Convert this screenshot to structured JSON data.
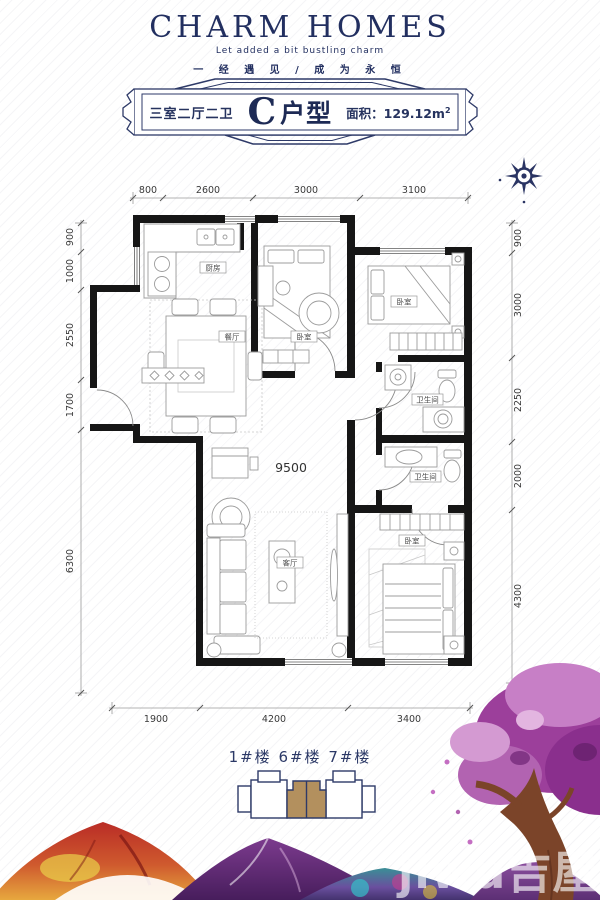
{
  "header": {
    "title": "CHARM HOMES",
    "subtitle": "Let added a bit bustling charm",
    "tagline": "一 经 遇 见 / 成 为 永 恒"
  },
  "banner": {
    "rooms": "三室二厅二卫",
    "unit_letter": "C",
    "unit_suffix": "户型",
    "area_label": "面积：129.12m",
    "area_sup": "2"
  },
  "plan": {
    "labels": {
      "kitchen": "厨房",
      "dining": "餐厅",
      "bedroom_a": "卧室",
      "bedroom_b": "卧室",
      "bath_a": "卫生间",
      "bath_b": "卫生间",
      "living": "客厅",
      "bedroom_c": "卧室",
      "span": "9500"
    },
    "dim_top": [
      "800",
      "2600",
      "3000",
      "3100"
    ],
    "dim_left": [
      "900",
      "1000",
      "2550",
      "1700",
      "6300"
    ],
    "dim_right": [
      "900",
      "3000",
      "2250",
      "2000",
      "4300"
    ],
    "dim_bottom": [
      "1900",
      "4200",
      "3400"
    ]
  },
  "footer": {
    "buildings": "1#楼 6#楼 7#楼",
    "watermark": "jiwu吉屋"
  },
  "colors": {
    "navy": "#26335f",
    "wall": "#161616",
    "highlight_unit_tan": "#b3905e",
    "tree_purple": "#9c3f9b"
  }
}
